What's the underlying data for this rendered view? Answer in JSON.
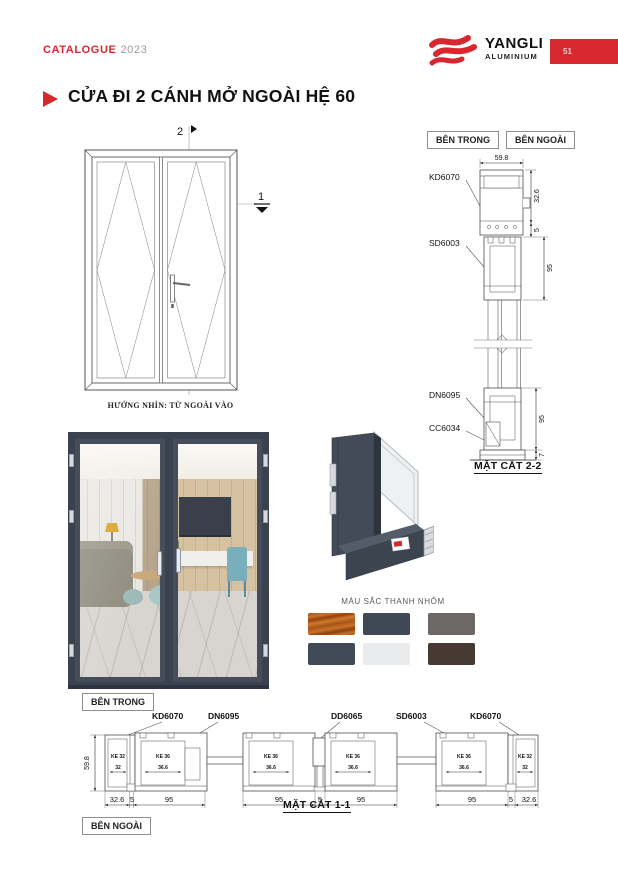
{
  "header": {
    "catalogue_label": "CATALOGUE",
    "year": "2023",
    "brand": "YANGLI",
    "brand_sub": "ALUMINIUM",
    "page_number": "51"
  },
  "title": "CỬA ĐI 2 CÁNH MỞ NGOÀI HỆ 60",
  "elevation": {
    "marker_vertical": "2",
    "marker_horizontal": "1",
    "caption": "HƯỚNG NHÌN: TỪ NGOÀI VÀO"
  },
  "section22": {
    "inside_label": "BÊN TRONG",
    "outside_label": "BÊN NGOÀI",
    "title": "MẶT CẮT 2-2",
    "label_kd": "KD6070",
    "label_sd": "SD6003",
    "label_dn": "DN6095",
    "label_cc": "CC6034",
    "dim_width": "59.8",
    "dim_frame": "32.6",
    "dim_gap": "5",
    "dim_leaf_top": "95",
    "dim_leaf_bottom": "95",
    "dim_sill": "7"
  },
  "palette": {
    "title": "MÀU SẮC THANH NHÔM",
    "swatches": [
      {
        "name": "wood-grain",
        "css": "background:linear-gradient(170deg,#a85418 0%,#c9722a 14%,#93420f 26%,#ce7a2e 38%,#a85418 52%,#c9722a 66%,#8f3e0d 78%,#c76f24 90%,#a85418 100%)"
      },
      {
        "name": "anthracite-blue",
        "css": "background:#3f4855"
      },
      {
        "name": "warm-gray",
        "css": "background:#6d6866"
      },
      {
        "name": "slate-gray",
        "css": "background:#414a57"
      },
      {
        "name": "light-gray",
        "css": "background:#e9ebec"
      },
      {
        "name": "dark-brown",
        "css": "background:#473a33"
      }
    ]
  },
  "section11": {
    "inside_label": "BÊN TRONG",
    "outside_label": "BÊN NGOÀI",
    "title": "MẶT CẮT 1-1",
    "label_1": "KD6070",
    "label_2": "DN6095",
    "label_3": "DD6065",
    "label_4": "SD6003",
    "label_5": "KD6070",
    "dim_height": "59.8",
    "dims": [
      "32.6",
      "5",
      "95",
      "95",
      "5",
      "95",
      "95",
      "5",
      "32.6"
    ],
    "ke32": "KE 32",
    "ke32_d": "32",
    "ke36": "KE 36",
    "ke36_d": "36.6"
  }
}
